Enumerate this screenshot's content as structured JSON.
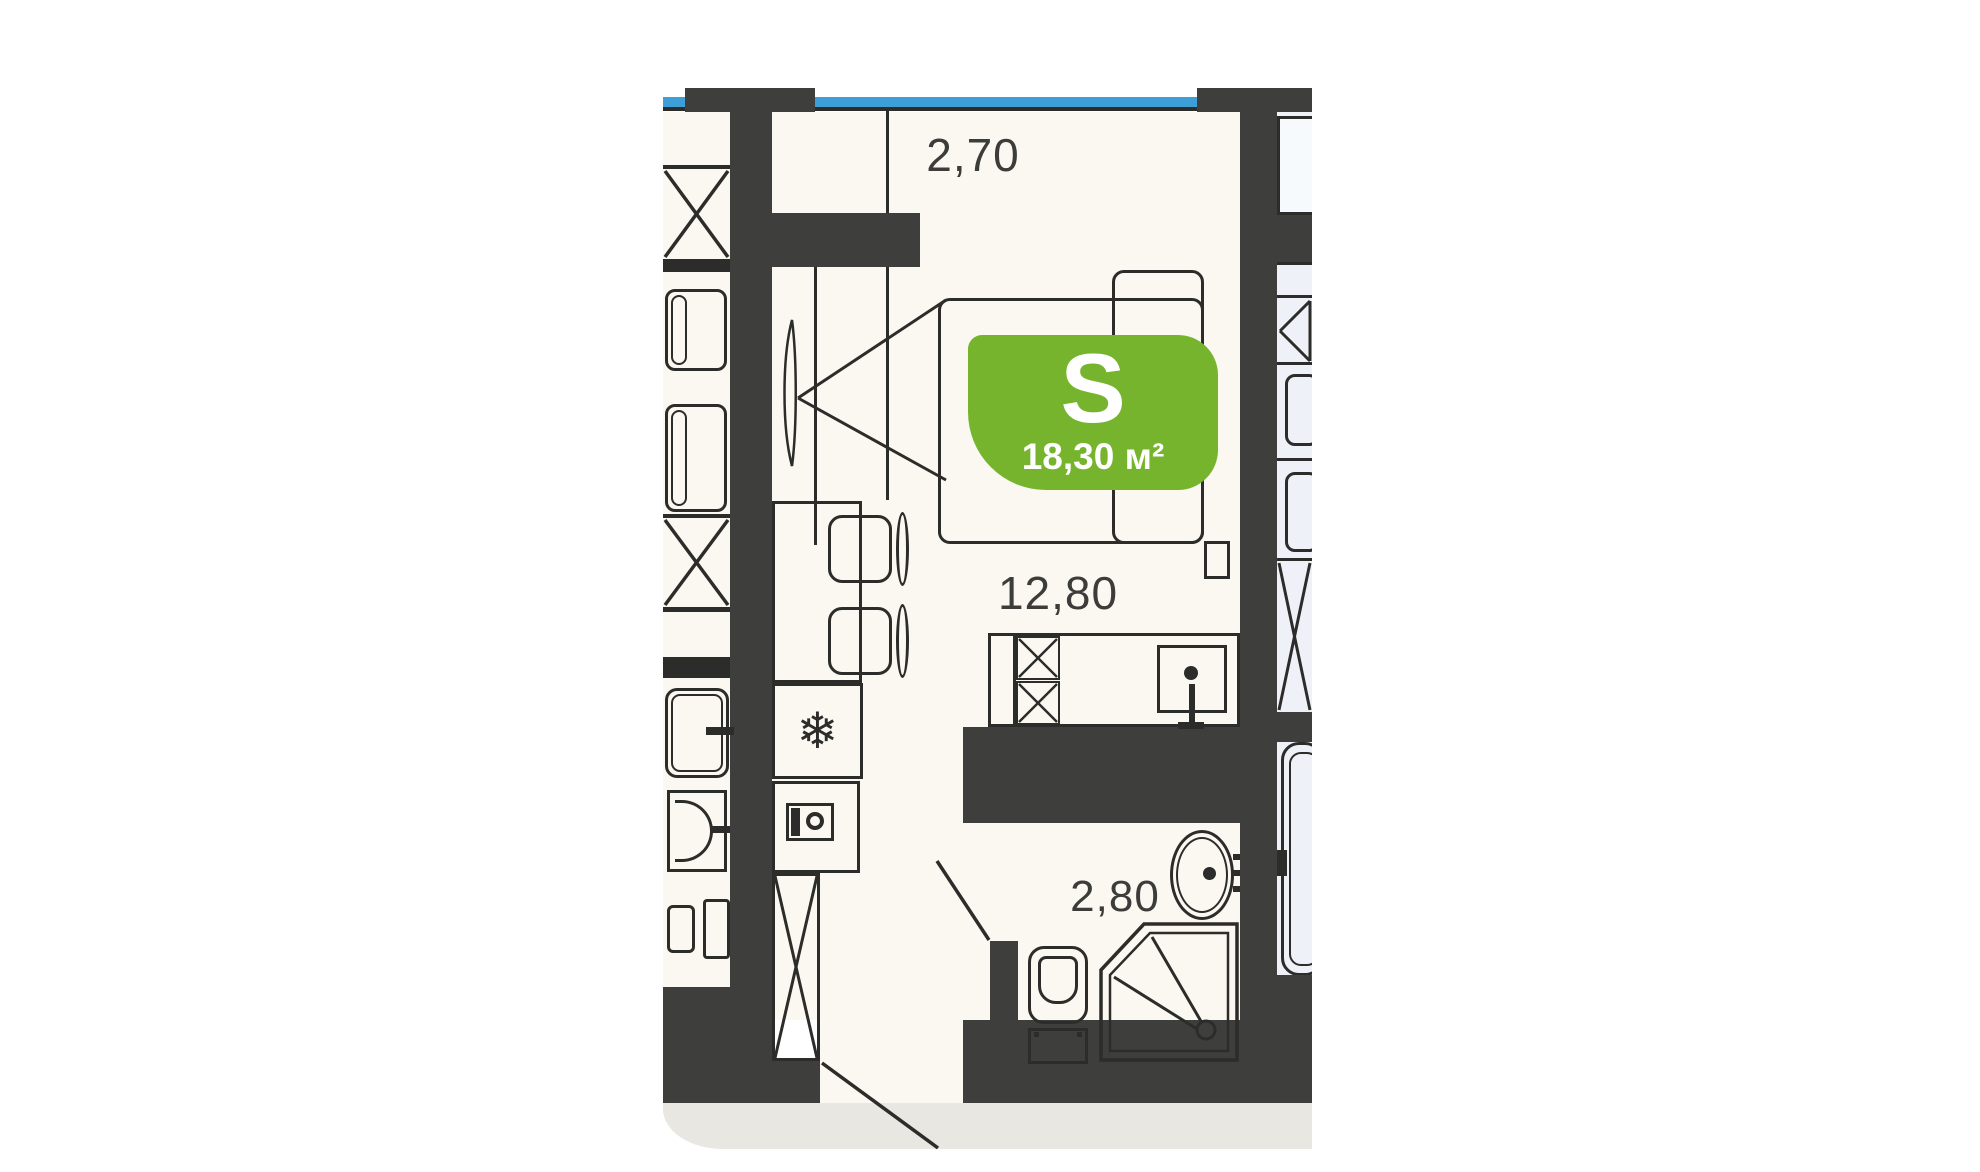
{
  "floorplan": {
    "area_badge": {
      "type_letter": "S",
      "area_value": "18,30 м²"
    },
    "dimensions": {
      "top": "2,70",
      "middle": "12,80",
      "bathroom": "2,80"
    },
    "icons": {
      "freezer": "❄"
    },
    "colors": {
      "wall": "#3e3e3c",
      "line": "#2c2c2a",
      "floor": "#faf8f1",
      "neighbor_floor": "#eef2f8",
      "window_glass": "#3d9ed8",
      "badge": "#77b42d",
      "corridor": "#e9e7e2",
      "dimension_text": "#3c3c3a"
    }
  }
}
